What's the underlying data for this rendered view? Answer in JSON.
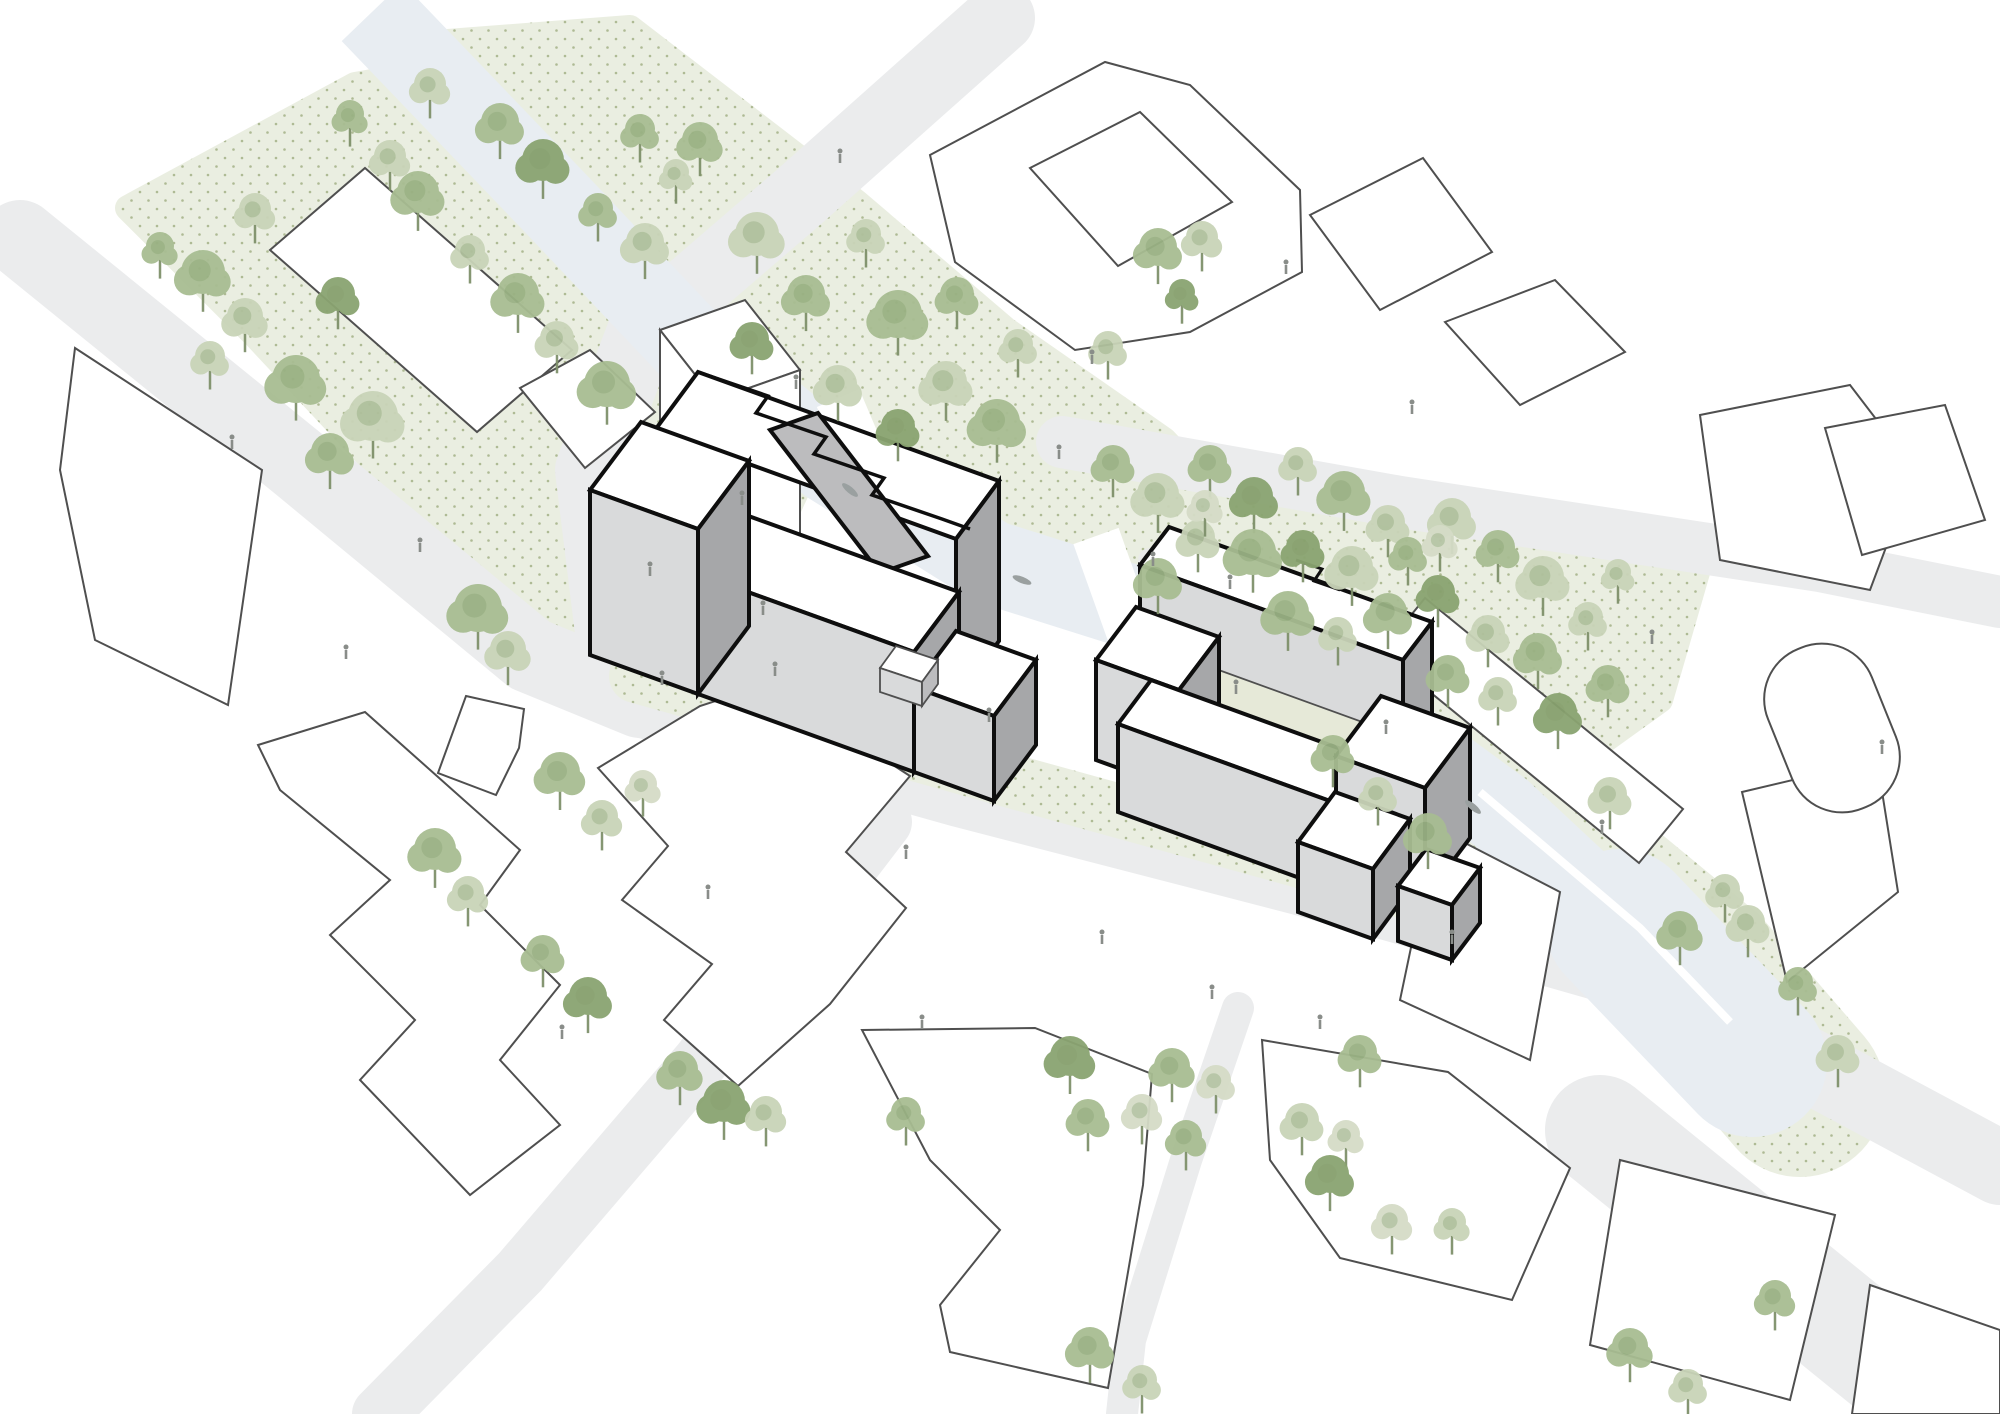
{
  "meta": {
    "title": "architectural-site-plan-axonometric",
    "description": "Axonometric urban site plan; two highlighted building complexes with heavy outlines among white context blocks, canal, roads, parks and trees. No visible text labels."
  },
  "palette": {
    "bg": "#ffffff",
    "road": "#ebeced",
    "road_minor": "#e9eae9",
    "park": "#eaeee1",
    "park_dot": "#aeba94",
    "canal": "#e8edf2",
    "bridge": "#ffffff",
    "quay": "#ffffff",
    "context_fill": "#ffffff",
    "context_stroke": "#4f4f4f",
    "focus_outline": "#0e0e0e",
    "focus_roof": "#ffffff",
    "focus_wall_light": "#d9dadb",
    "focus_wall_mid": "#bcbcbe",
    "focus_wall_dark": "#a6a7a9",
    "court_floor": "#e6e9d8",
    "tree_shades": [
      "#c9d4b8",
      "#a8bd92",
      "#8aa471",
      "#d5dcc7"
    ],
    "tree_accent": "#7e9a66",
    "trunk": "#7f916b",
    "person": "#898d89",
    "boat": "#9aa0a0"
  },
  "scene": {
    "parks": [
      {
        "name": "park-northwest",
        "pts": "128,208 355,85 430,72 770,428 806,470 772,544 640,655 560,665 470,565 255,335"
      },
      {
        "name": "park-north-of-canal",
        "pts": "448,42 630,28 856,202 1006,330 1164,440 1258,540 1184,622 1002,562 860,470 700,332 474,92"
      },
      {
        "name": "park-east-grove",
        "pts": "1076,452 1400,512 1700,562 1660,700 1560,772 1420,742 1340,742 1180,642 1078,542"
      }
    ],
    "bank": {
      "d": "M 1330,706 L 1530,836 L 1700,976 L 1800,1092",
      "w": 170
    },
    "sidewalk": {
      "d": "M 636,676 L 1000,778 L 1340,872 L 1530,930",
      "w": 54
    },
    "roads": [
      {
        "name": "road-northwest",
        "d": "M 20,238 L 300,465 L 530,655 L 640,700",
        "w": 76
      },
      {
        "name": "road-main-street",
        "d": "M 640,700 L 960,790 L 1300,878 L 1640,975 L 2000,1168",
        "w": 74
      },
      {
        "name": "road-north",
        "d": "M 1000,18 L 800,196 L 642,332 L 590,470 L 612,648",
        "w": 70
      },
      {
        "name": "road-east",
        "d": "M 1062,442 L 1400,502 L 1820,566 L 2000,602",
        "w": 52
      },
      {
        "name": "road-southwest",
        "d": "M 884,822 L 700,1062 L 520,1272 L 380,1414",
        "w": 56
      },
      {
        "name": "road-southeast-corner",
        "d": "M 1600,1130 L 1950,1414",
        "w": 110
      },
      {
        "name": "path-south",
        "d": "M 1238,1008 L 1186,1160 L 1130,1340 L 1122,1414",
        "w": 32
      }
    ],
    "park_paths": [
      {
        "name": "grove-path",
        "d": "M 1150,560 Q 1260,610 1396,692",
        "w": 24
      }
    ],
    "canal": {
      "main": {
        "d": "M 372,12 L 560,208 L 700,356 L 830,462 L 990,562 L 1180,622 L 1355,706 L 1500,812 L 1620,924 L 1724,1036",
        "w": 84
      },
      "basin": {
        "d": "M 1620,924 L 1752,1062",
        "w": 150
      },
      "quays": [
        {
          "d": "M 1480,792 L 1640,928 L 1730,1022",
          "w": 8
        }
      ]
    },
    "bridges": [
      {
        "name": "bridge-west",
        "d": "M 838,398 L 884,506",
        "w": 46
      },
      {
        "name": "bridge-middle",
        "d": "M 1096,536 L 1136,648",
        "w": 48
      },
      {
        "name": "bridge-east",
        "d": "M 1388,748 L 1442,836",
        "w": 44
      }
    ],
    "context_buildings": [
      {
        "name": "slab-northwest",
        "pts": "365,168 572,350 477,432 270,250"
      },
      {
        "name": "house-northwest",
        "pts": "520,388 590,350 655,412 585,468"
      },
      {
        "name": "courtyard-block-northeast",
        "outer": "930,155 1105,62 1190,85 1300,190 1302,272 1190,332 1075,350 955,262",
        "hole": "1030,168 1140,112 1232,202 1118,266"
      },
      {
        "name": "diamond-block-northeast",
        "pts": "1310,215 1423,158 1492,252 1380,310"
      },
      {
        "name": "block-north-of-grove",
        "pts": "1445,322 1555,280 1625,352 1520,405"
      },
      {
        "name": "block-east-upper",
        "pts": "1700,415 1850,385 1915,470 1870,590 1720,560"
      },
      {
        "name": "block-east-edge",
        "pts": "1825,428 1945,405 1985,520 1862,555"
      },
      {
        "name": "slab-along-grove",
        "pts": "1425,598 1683,809 1639,863 1381,652"
      },
      {
        "name": "block-east-of-basin",
        "pts": "1742,792 1877,760 1898,892 1787,982"
      },
      {
        "name": "block-west-of-basin",
        "pts": "1436,828 1560,892 1530,1060 1400,1000"
      },
      {
        "name": "block-far-west",
        "pts": "75,348 262,470 228,705 95,640 60,470"
      },
      {
        "name": "block-junction-south",
        "pts": "466,696 524,709 519,748 496,795 438,773"
      },
      {
        "name": "zigzag-complex-southwest",
        "pts": "258,745 365,712 520,850 480,905 560,985 500,1060 560,1125 470,1195 360,1080 415,1020 330,935 390,880 280,790"
      },
      {
        "name": "complex-south-center-west",
        "pts": "598,768 700,706 768,684 910,776 846,852 906,908 830,1004 738,1086 664,1020 712,964 622,900 668,846"
      },
      {
        "name": "block-south-center",
        "pts": "862,1030 1035,1028 1152,1074 1143,1185 1108,1388 950,1352 940,1305 1000,1230 930,1160"
      },
      {
        "name": "block-south-east",
        "pts": "1262,1040 1448,1072 1570,1168 1512,1300 1340,1258 1270,1160"
      },
      {
        "name": "block-bottom-right",
        "pts": "1620,1160 1835,1215 1790,1400 1590,1345"
      },
      {
        "name": "block-bottom-right-corner",
        "pts": "1870,1285 2000,1330 2000,1414 1852,1414"
      }
    ],
    "gasholder": {
      "cx": 1832,
      "cy": 728,
      "w": 112,
      "h": 172,
      "rx": 54,
      "angle": -22
    },
    "context_prism_tower": [
      {
        "pts": "660,330 745,300 800,370 715,400",
        "fill": "roof"
      },
      {
        "pts": "660,330 715,400 715,688 660,618",
        "fill": "roof"
      },
      {
        "pts": "715,400 800,370 800,658 715,688",
        "fill": "roof"
      }
    ],
    "focus_complex_a": [
      {
        "pts": "655,430 956,539 999,481 698,372",
        "fill": "roof",
        "stroke": "heavy"
      },
      {
        "pts": "956,539 999,481 999,641 956,699",
        "fill": "dark",
        "stroke": "heavy"
      },
      {
        "pts": "770,430 818,413 928,556 880,573",
        "fill": "mid",
        "stroke": "heavy"
      },
      {
        "pts": "698,574 914,652 959,592 743,514",
        "fill": "roof",
        "stroke": "heavy"
      },
      {
        "pts": "698,574 914,652 914,772 698,694",
        "fill": "light",
        "stroke": "heavy"
      },
      {
        "pts": "914,652 959,592 959,712 914,772",
        "fill": "dark",
        "stroke": "heavy"
      },
      {
        "pts": "590,490 698,529 749,461 641,422",
        "fill": "roof",
        "stroke": "heavy"
      },
      {
        "pts": "590,490 698,529 698,694 590,655",
        "fill": "light",
        "stroke": "heavy"
      },
      {
        "pts": "698,529 749,461 749,626 698,694",
        "fill": "dark",
        "stroke": "heavy"
      },
      {
        "pts": "914,687 994,716 1036,660 956,631",
        "fill": "roof",
        "stroke": "heavy"
      },
      {
        "pts": "914,687 994,716 994,801 914,772",
        "fill": "light",
        "stroke": "heavy"
      },
      {
        "pts": "994,716 1036,660 1036,745 994,801",
        "fill": "dark",
        "stroke": "heavy"
      },
      {
        "pts": "880,668 922,682 938,660 896,646",
        "fill": "roof",
        "stroke": "thin"
      },
      {
        "pts": "880,668 922,682 922,706 880,692",
        "fill": "light",
        "stroke": "thin"
      },
      {
        "pts": "922,682 938,660 938,684 922,706",
        "fill": "mid",
        "stroke": "thin"
      }
    ],
    "focus_a_sawtooth": "698,372 768,396 756,413 826,437 814,454 884,478 872,495 942,519 970,529",
    "focus_complex_b": [
      {
        "pts": "1140,565 1403,660 1432,622 1169,527",
        "fill": "roof",
        "stroke": "heavy"
      },
      {
        "pts": "1140,565 1403,660 1403,795 1140,700",
        "fill": "light",
        "stroke": "heavy"
      },
      {
        "pts": "1403,660 1432,622 1432,757 1403,795",
        "fill": "dark",
        "stroke": "heavy"
      },
      {
        "pts": "1150,696 1360,772 1390,732 1180,656",
        "fill": "court",
        "stroke": "thin"
      },
      {
        "pts": "1096,660 1179,690 1219,637 1136,607",
        "fill": "roof",
        "stroke": "heavy"
      },
      {
        "pts": "1096,660 1179,690 1179,790 1096,760",
        "fill": "light",
        "stroke": "heavy"
      },
      {
        "pts": "1179,690 1219,637 1219,737 1179,790",
        "fill": "dark",
        "stroke": "heavy"
      },
      {
        "pts": "1118,724 1330,801 1363,757 1151,680",
        "fill": "roof",
        "stroke": "heavy"
      },
      {
        "pts": "1118,724 1330,801 1330,889 1118,812",
        "fill": "light",
        "stroke": "heavy"
      },
      {
        "pts": "1330,801 1363,757 1363,845 1330,889",
        "fill": "dark",
        "stroke": "heavy"
      },
      {
        "pts": "1336,756 1425,788 1470,728 1381,696",
        "fill": "roof",
        "stroke": "heavy"
      },
      {
        "pts": "1336,756 1425,788 1425,898 1336,866",
        "fill": "light",
        "stroke": "heavy"
      },
      {
        "pts": "1425,788 1470,728 1470,838 1425,898",
        "fill": "dark",
        "stroke": "heavy"
      },
      {
        "pts": "1298,842 1373,869 1410,819 1335,792",
        "fill": "roof",
        "stroke": "heavy"
      },
      {
        "pts": "1298,842 1373,869 1373,939 1298,912",
        "fill": "light",
        "stroke": "heavy"
      },
      {
        "pts": "1373,869 1410,819 1410,889 1373,939",
        "fill": "dark",
        "stroke": "heavy"
      },
      {
        "pts": "1398,886 1452,905 1480,868 1426,849",
        "fill": "roof",
        "stroke": "heavy"
      },
      {
        "pts": "1398,886 1452,905 1452,960 1398,941",
        "fill": "light",
        "stroke": "heavy"
      },
      {
        "pts": "1452,905 1480,868 1480,923 1452,960",
        "fill": "dark",
        "stroke": "heavy"
      }
    ],
    "focus_b_notch": "1296,560 1322,569 1314,581 1340,590",
    "trees": [
      [
        203,
        278,
        22,
        1
      ],
      [
        245,
        322,
        18,
        0
      ],
      [
        296,
        385,
        24,
        1
      ],
      [
        338,
        300,
        17,
        2
      ],
      [
        373,
        422,
        25,
        0
      ],
      [
        330,
        458,
        19,
        1
      ],
      [
        418,
        198,
        21,
        1
      ],
      [
        390,
        162,
        16,
        0
      ],
      [
        500,
        128,
        19,
        1
      ],
      [
        543,
        166,
        21,
        2
      ],
      [
        470,
        256,
        15,
        0
      ],
      [
        518,
        300,
        21,
        1
      ],
      [
        557,
        344,
        17,
        0
      ],
      [
        607,
        390,
        23,
        1
      ],
      [
        645,
        248,
        19,
        0
      ],
      [
        598,
        214,
        15,
        1
      ],
      [
        676,
        178,
        13,
        0
      ],
      [
        640,
        135,
        15,
        1
      ],
      [
        430,
        90,
        16,
        0
      ],
      [
        350,
        120,
        14,
        1
      ],
      [
        255,
        215,
        16,
        0
      ],
      [
        160,
        252,
        14,
        1
      ],
      [
        210,
        362,
        15,
        0
      ],
      [
        700,
        146,
        18,
        1
      ],
      [
        757,
        240,
        22,
        0
      ],
      [
        806,
        300,
        19,
        1
      ],
      [
        752,
        345,
        17,
        2
      ],
      [
        866,
        240,
        15,
        0
      ],
      [
        898,
        320,
        24,
        1
      ],
      [
        946,
        388,
        21,
        0
      ],
      [
        997,
        428,
        23,
        1
      ],
      [
        898,
        432,
        17,
        2
      ],
      [
        838,
        390,
        19,
        0
      ],
      [
        957,
        300,
        17,
        1
      ],
      [
        1018,
        350,
        15,
        0
      ],
      [
        1158,
        253,
        19,
        1
      ],
      [
        1202,
        243,
        16,
        0
      ],
      [
        1182,
        298,
        13,
        2
      ],
      [
        1108,
        352,
        15,
        0
      ],
      [
        1113,
        468,
        17,
        1
      ],
      [
        1158,
        500,
        21,
        0
      ],
      [
        1210,
        468,
        17,
        1
      ],
      [
        1254,
        502,
        19,
        2
      ],
      [
        1298,
        468,
        15,
        0
      ],
      [
        1344,
        498,
        21,
        1
      ],
      [
        1388,
        528,
        17,
        0
      ],
      [
        1253,
        558,
        23,
        1
      ],
      [
        1198,
        543,
        17,
        0
      ],
      [
        1158,
        583,
        19,
        1
      ],
      [
        1303,
        553,
        17,
        2
      ],
      [
        1352,
        573,
        21,
        0
      ],
      [
        1408,
        558,
        15,
        1
      ],
      [
        1452,
        523,
        19,
        0
      ],
      [
        1498,
        553,
        17,
        1
      ],
      [
        1543,
        583,
        21,
        0
      ],
      [
        1438,
        598,
        17,
        2
      ],
      [
        1388,
        618,
        19,
        1
      ],
      [
        1338,
        638,
        15,
        0
      ],
      [
        1288,
        618,
        21,
        1
      ],
      [
        1488,
        638,
        17,
        0
      ],
      [
        1538,
        658,
        19,
        1
      ],
      [
        1588,
        623,
        15,
        0
      ],
      [
        1608,
        688,
        17,
        1
      ],
      [
        1558,
        718,
        19,
        2
      ],
      [
        1498,
        698,
        15,
        0
      ],
      [
        1448,
        678,
        17,
        1
      ],
      [
        1618,
        578,
        13,
        0
      ],
      [
        1205,
        510,
        14,
        3
      ],
      [
        1440,
        545,
        14,
        3
      ],
      [
        1333,
        758,
        17,
        1
      ],
      [
        1378,
        798,
        15,
        0
      ],
      [
        1428,
        838,
        19,
        1
      ],
      [
        1610,
        800,
        17,
        0
      ],
      [
        1680,
        935,
        18,
        1
      ],
      [
        1725,
        895,
        15,
        0
      ],
      [
        1748,
        928,
        17,
        0
      ],
      [
        1798,
        988,
        15,
        1
      ],
      [
        1838,
        1058,
        17,
        0
      ],
      [
        478,
        614,
        24,
        1
      ],
      [
        508,
        655,
        18,
        0
      ],
      [
        560,
        778,
        20,
        1
      ],
      [
        602,
        822,
        16,
        0
      ],
      [
        643,
        790,
        14,
        3
      ],
      [
        435,
        855,
        21,
        1
      ],
      [
        468,
        898,
        16,
        0
      ],
      [
        543,
        958,
        17,
        1
      ],
      [
        588,
        1002,
        19,
        2
      ],
      [
        680,
        1075,
        18,
        1
      ],
      [
        724,
        1107,
        21,
        2
      ],
      [
        766,
        1118,
        16,
        0
      ],
      [
        906,
        1118,
        15,
        1
      ],
      [
        1172,
        1072,
        18,
        1
      ],
      [
        1216,
        1086,
        15,
        3
      ],
      [
        1186,
        1142,
        16,
        1
      ],
      [
        1302,
        1126,
        17,
        0
      ],
      [
        1346,
        1140,
        14,
        3
      ],
      [
        1070,
        1062,
        20,
        2
      ],
      [
        1088,
        1122,
        17,
        1
      ],
      [
        1142,
        1116,
        16,
        3
      ],
      [
        1360,
        1058,
        17,
        1
      ],
      [
        1330,
        1180,
        19,
        2
      ],
      [
        1392,
        1226,
        16,
        3
      ],
      [
        1452,
        1228,
        14,
        0
      ],
      [
        1090,
        1352,
        19,
        1
      ],
      [
        1142,
        1386,
        15,
        0
      ],
      [
        1630,
        1352,
        18,
        1
      ],
      [
        1688,
        1390,
        15,
        0
      ],
      [
        1775,
        1302,
        16,
        1
      ]
    ],
    "people": [
      [
        796,
        386
      ],
      [
        742,
        502
      ],
      [
        650,
        573
      ],
      [
        662,
        682
      ],
      [
        775,
        673
      ],
      [
        708,
        896
      ],
      [
        763,
        612
      ],
      [
        989,
        719
      ],
      [
        1059,
        456
      ],
      [
        1153,
        563
      ],
      [
        1230,
        586
      ],
      [
        1236,
        691
      ],
      [
        1386,
        731
      ],
      [
        1452,
        941
      ],
      [
        1102,
        941
      ],
      [
        922,
        1026
      ],
      [
        1212,
        996
      ],
      [
        1602,
        831
      ],
      [
        232,
        446
      ],
      [
        346,
        656
      ],
      [
        420,
        549
      ],
      [
        1286,
        271
      ],
      [
        1412,
        411
      ],
      [
        1652,
        641
      ],
      [
        1882,
        751
      ],
      [
        562,
        1036
      ],
      [
        906,
        856
      ],
      [
        1092,
        361
      ],
      [
        1320,
        1026
      ],
      [
        840,
        160
      ]
    ],
    "boats": [
      [
        850,
        490,
        40
      ],
      [
        1022,
        580,
        22
      ],
      [
        1473,
        807,
        40
      ]
    ]
  }
}
